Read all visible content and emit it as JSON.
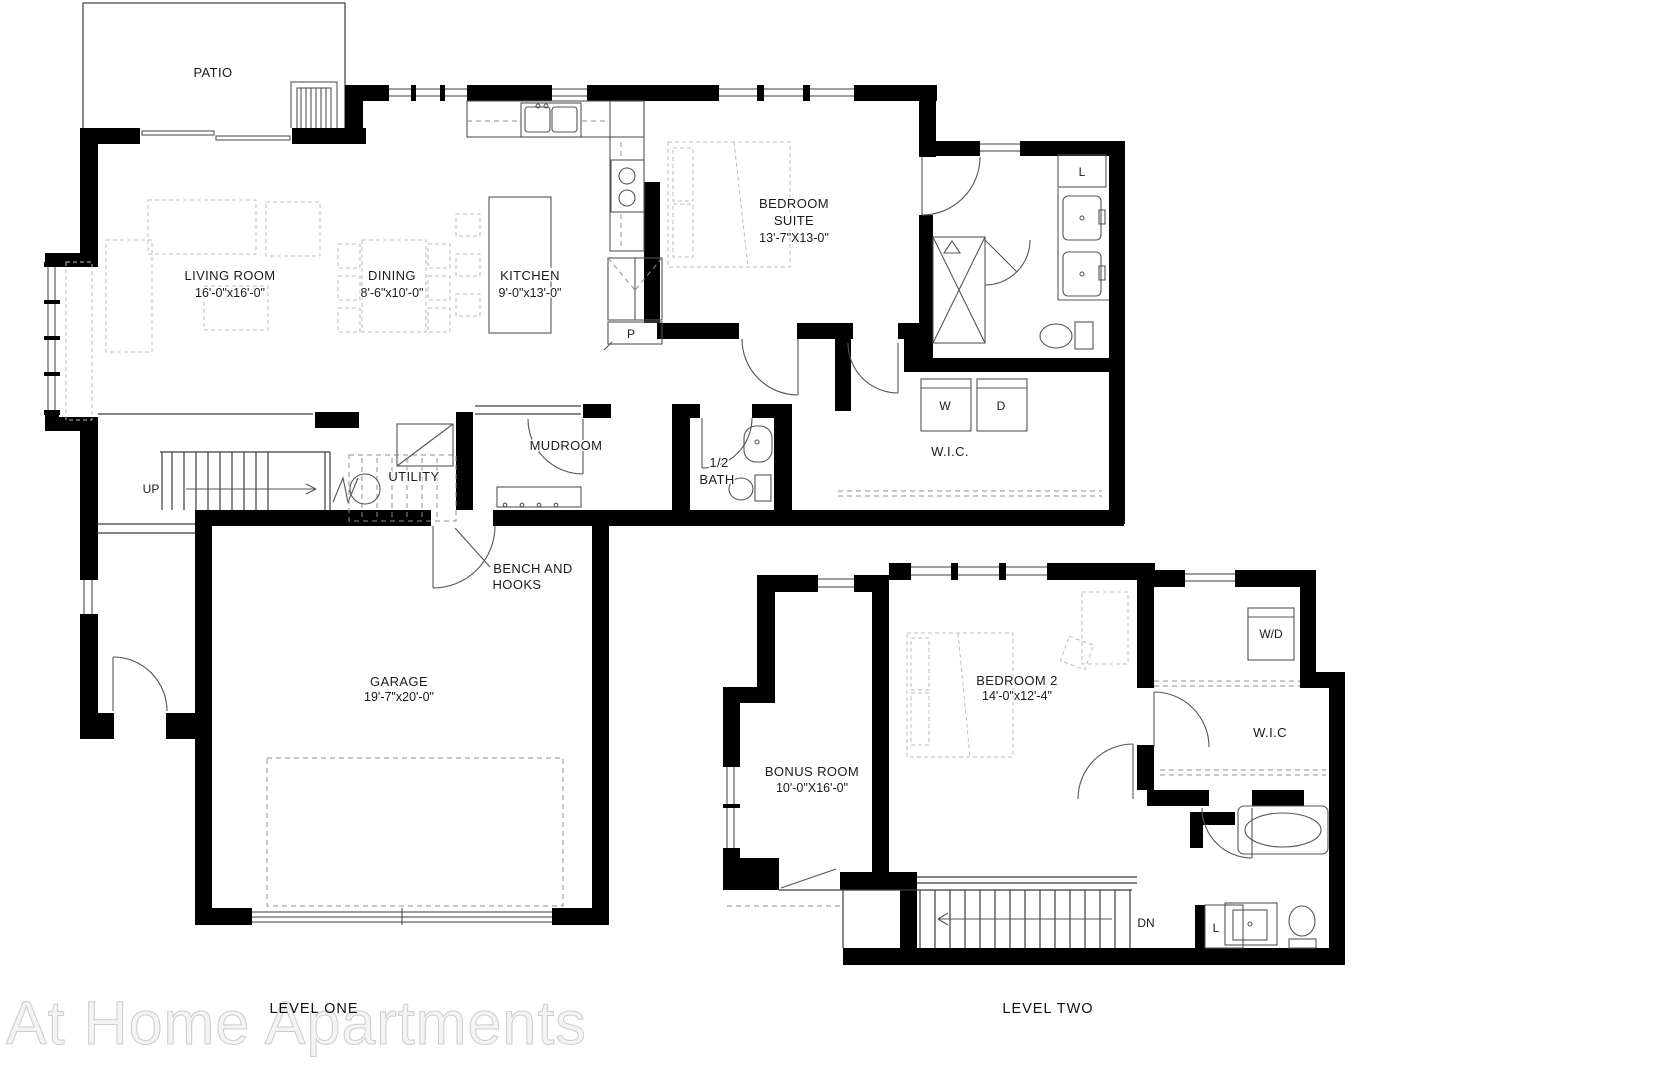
{
  "watermark": "At Home Apartments",
  "level_one": {
    "title": "LEVEL ONE",
    "rooms": {
      "patio": {
        "label": "PATIO"
      },
      "living": {
        "label": "LIVING ROOM",
        "dims": "16'-0\"x16'-0\""
      },
      "dining": {
        "label": "DINING",
        "dims": "8'-6\"x10'-0\""
      },
      "kitchen": {
        "label": "KITCHEN",
        "dims": "9'-0\"x13'-0\""
      },
      "bedroom_suite": {
        "line1": "BEDROOM",
        "line2": "SUITE",
        "dims": "13'-7\"X13-0\""
      },
      "mudroom": {
        "label": "MUDROOM"
      },
      "utility": {
        "label": "UTILITY"
      },
      "half_bath": {
        "line1": "1/2",
        "line2": "BATH"
      },
      "wic": {
        "label": "W.I.C."
      },
      "garage": {
        "label": "GARAGE",
        "dims": "19'-7\"x20'-0\""
      }
    },
    "annotations": {
      "up": "UP",
      "pantry": "P",
      "washer": "W",
      "dryer": "D",
      "linen": "L",
      "bench_line1": "BENCH AND",
      "bench_line2": "HOOKS"
    }
  },
  "level_two": {
    "title": "LEVEL TWO",
    "rooms": {
      "bonus": {
        "label": "BONUS ROOM",
        "dims": "10'-0\"X16'-0\""
      },
      "bedroom2": {
        "label": "BEDROOM 2",
        "dims": "14'-0\"x12'-4\""
      },
      "wic": {
        "label": "W.I.C"
      }
    },
    "annotations": {
      "washer_dryer": "W/D",
      "down": "DN",
      "linen": "L"
    }
  }
}
